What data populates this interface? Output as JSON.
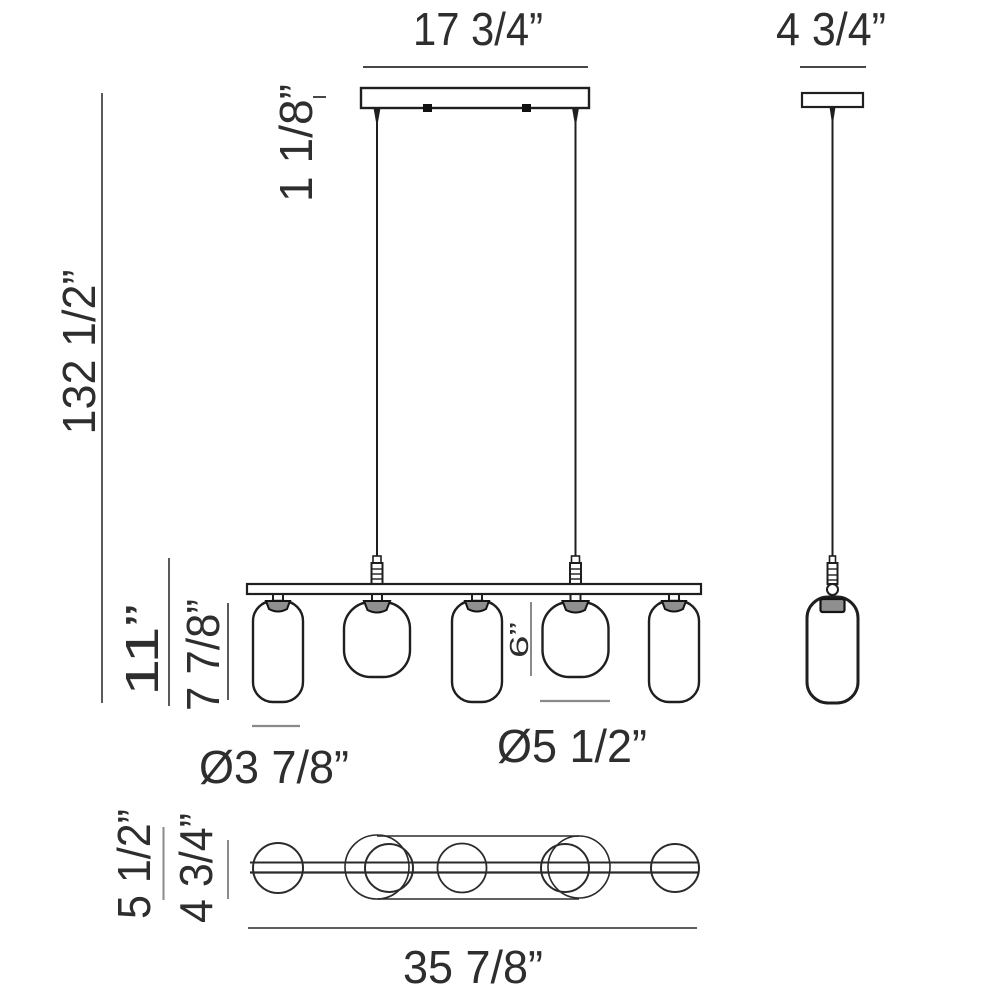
{
  "drawing": "pendant-light-fixture-dimension-diagram",
  "labels": {
    "canopy_length": "17 3/4”",
    "canopy_side_width": "4 3/4”",
    "overall_height": "132 1/2”",
    "canopy_height": "1 1/8”",
    "pendant_drop_height": "11”",
    "tall_glass_height": "7 7/8”",
    "short_glass_height": "6”",
    "small_glass_diameter": "Ø3 7/8”",
    "large_glass_diameter": "Ø5 1/2”",
    "plan_large_diameter": "5 1/2”",
    "plan_small_diameter": "4 3/4”",
    "overall_length": "35 7/8”"
  },
  "colors": {
    "background": "#ffffff",
    "fixture_ink": "#1f1f1f",
    "dimension_dark": "#474747",
    "dimension_gray": "#8a8a8a",
    "text": "#2e2e2e",
    "socket_fill": "#8f8f8f"
  }
}
